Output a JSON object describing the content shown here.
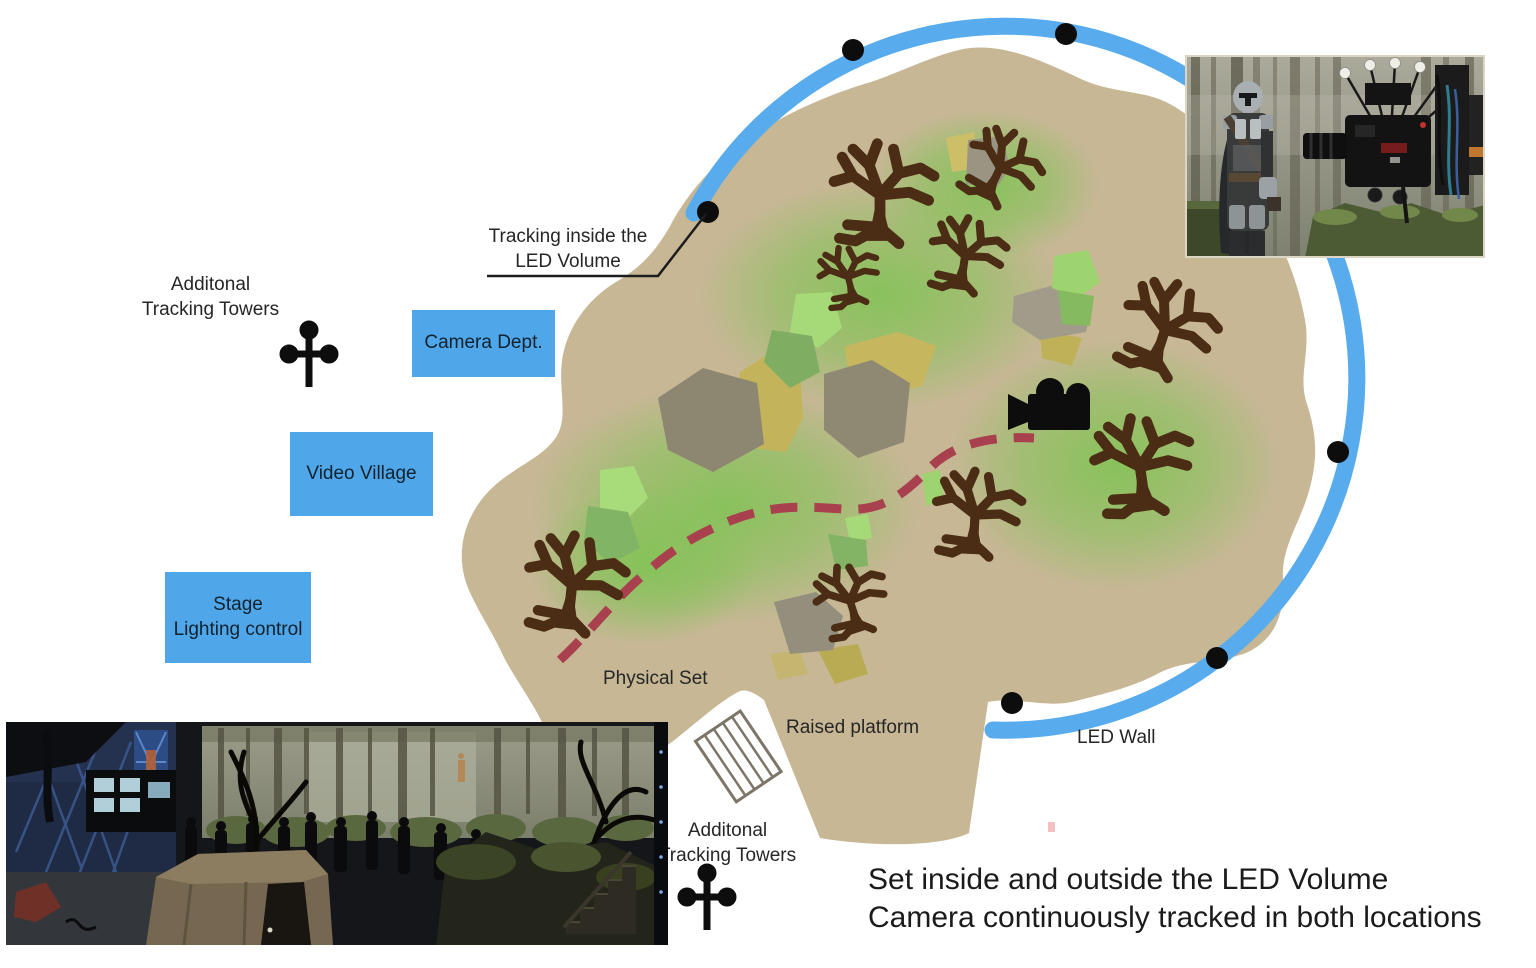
{
  "page": {
    "background": "#FFFFFF"
  },
  "labels": {
    "towers_top_line1": "Additonal",
    "towers_top_line2": "Tracking Towers",
    "tracking_inside_line1": "Tracking inside the",
    "tracking_inside_line2": "LED Volume",
    "camera_dept": "Camera Dept.",
    "video_village": "Video Village",
    "stage_line1": "Stage",
    "stage_line2": "Lighting control",
    "physical_set": "Physical Set",
    "raised_platform": "Raised platform",
    "led_wall": "LED Wall",
    "towers_bottom_line1": "Additonal",
    "towers_bottom_line2": "Tracking Towers",
    "caption_line1": "Set inside and outside the LED Volume",
    "caption_line2": "Camera continuously tracked in both locations"
  },
  "colors": {
    "led_wall_arc": "#58ABEC",
    "label_box_fill": "#4FA7EA",
    "set_ground": "#C7B795",
    "grass_glow": "#7CC450",
    "tree_brown": "#4B2C14",
    "rock_gray": "#8D8671",
    "camera_path_red": "#A8404D",
    "marker_black": "#0D0D0D",
    "leader_line": "#1D1D1D",
    "platform_outline": "#7D7668"
  },
  "icons": {
    "tracking_tower": "tracking-tower-icon",
    "movie_camera": "movie-camera-icon",
    "tracking_marker": "tracking-marker-dot",
    "raised_platform_hatch": "raised-platform-hatch-icon",
    "tree": "tree-icon"
  },
  "photos": {
    "top_right": "behind-the-scenes-mandalorian-camera-photo",
    "bottom_left": "led-volume-stage-set-photo"
  }
}
